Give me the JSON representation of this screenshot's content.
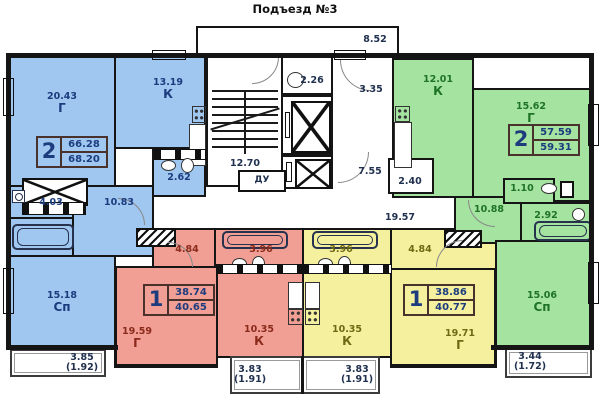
{
  "title": "Подъезд №3",
  "colors": {
    "wall": "#151515",
    "blue_fill": "#9fc7f0",
    "blue_ink": "#1c3c7e",
    "red_fill": "#f19e94",
    "red_ink": "#8a2a1a",
    "yellow_fill": "#f4f09e",
    "yellow_ink": "#6f6913",
    "green_fill": "#a5e3a0",
    "green_ink": "#1f7326",
    "common_ink": "#20304f",
    "badge_ink": "#1c3c7e"
  },
  "apartments": {
    "blue": {
      "badge": {
        "rooms": "2",
        "total": "66.28",
        "living": "68.20"
      },
      "rooms": {
        "living": {
          "area": "20.43",
          "type": "Г"
        },
        "kitchen": {
          "area": "13.19",
          "type": "К"
        },
        "bath": {
          "area": "2.62"
        },
        "wc": {
          "area": "4.03"
        },
        "hall": {
          "area": "10.83"
        },
        "bedroom": {
          "area": "15.18",
          "type": "Сп"
        }
      },
      "balcony": {
        "area": "3.85",
        "reduced": "(1.92)"
      }
    },
    "red": {
      "badge": {
        "rooms": "1",
        "total": "38.74",
        "living": "40.65"
      },
      "rooms": {
        "hall": {
          "area": "4.84"
        },
        "bath": {
          "area": "3.96"
        },
        "living": {
          "area": "19.59",
          "type": "Г"
        },
        "kitchen": {
          "area": "10.35",
          "type": "К"
        }
      },
      "balcony": {
        "area": "3.83",
        "reduced": "(1.91)"
      }
    },
    "yellow": {
      "badge": {
        "rooms": "1",
        "total": "38.86",
        "living": "40.77"
      },
      "rooms": {
        "bath": {
          "area": "3.96"
        },
        "hall": {
          "area": "4.84"
        },
        "kitchen": {
          "area": "10.35",
          "type": "К"
        },
        "living": {
          "area": "19.71",
          "type": "Г"
        }
      },
      "balcony": {
        "area": "3.83",
        "reduced": "(1.91)"
      }
    },
    "green": {
      "badge": {
        "rooms": "2",
        "total": "57.59",
        "living": "59.31"
      },
      "rooms": {
        "kitchen": {
          "area": "12.01",
          "type": "К"
        },
        "living": {
          "area": "15.62",
          "type": "Г"
        },
        "wc": {
          "area": "1.10"
        },
        "hall": {
          "area": "10.88"
        },
        "bath": {
          "area": "2.92"
        },
        "bedroom": {
          "area": "15.06",
          "type": "Сп"
        }
      },
      "balcony": {
        "area": "3.44",
        "reduced": "(1.72)"
      }
    }
  },
  "common": {
    "vestibule": "8.52",
    "trash_chute_room": "2.26",
    "corridor_upper": "3.35",
    "stairs": "12.70",
    "smoke_duct": "ДУ",
    "corridor_lower": "7.55",
    "storeroom": "2.40",
    "corridor_main": "19.57"
  }
}
